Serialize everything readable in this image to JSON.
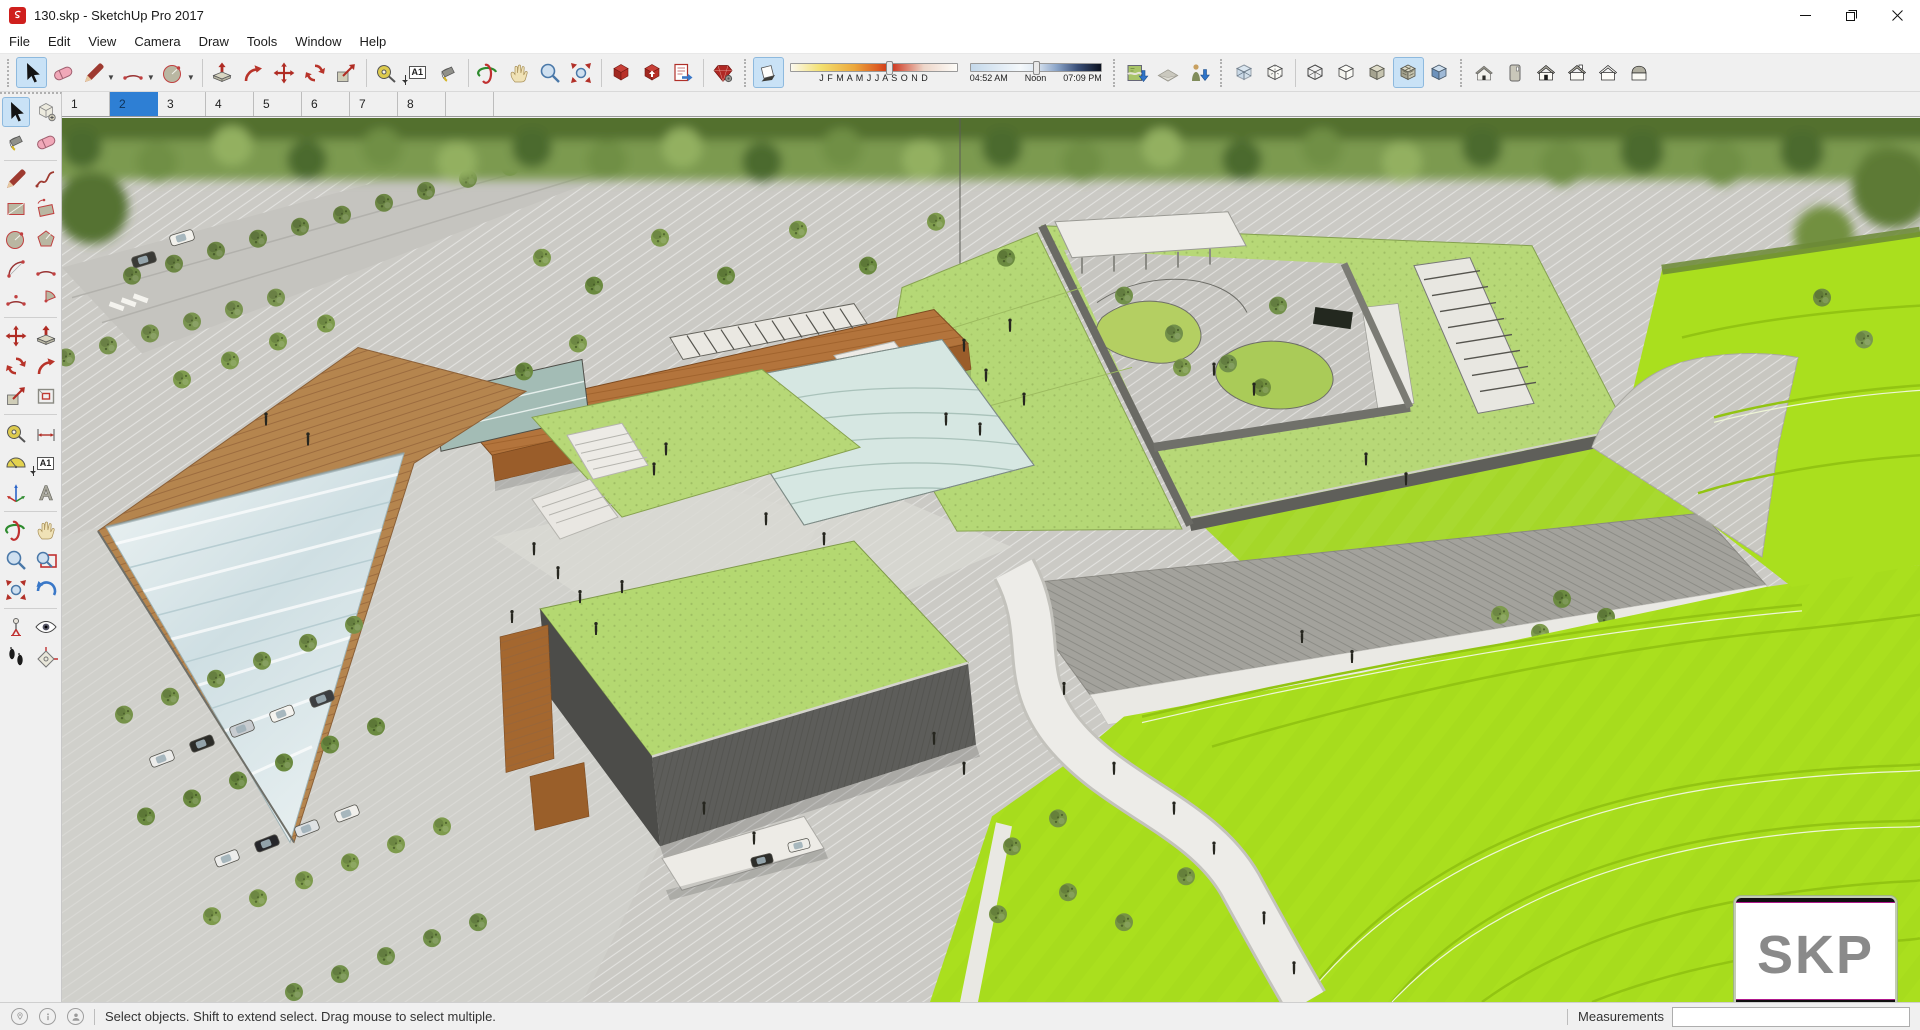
{
  "window": {
    "title": "130.skp - SketchUp Pro 2017"
  },
  "menu": {
    "items": [
      "File",
      "Edit",
      "View",
      "Camera",
      "Draw",
      "Tools",
      "Window",
      "Help"
    ]
  },
  "toolbar": {
    "text_icon_label": "A1",
    "icons": [
      "select",
      "eraser",
      "line",
      "2-point-arc",
      "shapes",
      "push-pull",
      "follow-me",
      "move",
      "rotate",
      "scale",
      "tape-measure",
      "text",
      "paint-bucket",
      "orbit",
      "pan",
      "zoom",
      "zoom-extents",
      "3d-warehouse",
      "share-model",
      "send-to-layout",
      "extension-warehouse",
      "shadows-toggle",
      "add-location",
      "toggle-terrain",
      "photo-textures",
      "x-ray",
      "back-edges",
      "wireframe",
      "hidden-line",
      "shaded",
      "shaded-with-textures",
      "monochrome",
      "iso-view",
      "top-view",
      "front-view",
      "right-view",
      "back-view",
      "left-view"
    ],
    "active_tool": "select",
    "active_style": "shaded-with-textures",
    "shadows": {
      "months_display": "J F M A M J J A S O N D",
      "time_start": "04:52 AM",
      "time_mid": "Noon",
      "time_end": "07:09 PM",
      "date_slider_pos": "57%",
      "time_slider_pos": "48%"
    }
  },
  "scene_tabs": {
    "labels": [
      "1",
      "2",
      "3",
      "4",
      "5",
      "6",
      "7",
      "8"
    ],
    "active": "2"
  },
  "palette_icons": [
    "select",
    "make-component",
    "paint-bucket",
    "eraser",
    "line",
    "freehand",
    "rectangle",
    "rotated-rectangle",
    "circle",
    "polygon",
    "arc",
    "2-point-arc",
    "3-point-arc",
    "pie",
    "move",
    "push-pull",
    "rotate",
    "follow-me",
    "scale",
    "offset",
    "tape-measure",
    "dimension",
    "protractor",
    "text",
    "axes",
    "3d-text",
    "orbit",
    "pan",
    "zoom",
    "zoom-window",
    "zoom-extents",
    "previous",
    "position-camera",
    "look-around",
    "walk",
    "section-plane"
  ],
  "statusbar": {
    "message": "Select objects. Shift to extend select. Drag mouse to select multiple.",
    "measurements_label": "Measurements",
    "measurements_value": ""
  },
  "watermark": {
    "text": "SKP"
  },
  "colors": {
    "active_tool_bg": "#c9e2f6",
    "active_tab": "#2e7fd4",
    "bright_green": "#aadf1e",
    "roof_green": "#b7d877",
    "pavement": "#cbcac5",
    "wood_deck": "#b5854e",
    "building_brown": "#b3743c",
    "wall_gray": "#5d5d5a"
  }
}
